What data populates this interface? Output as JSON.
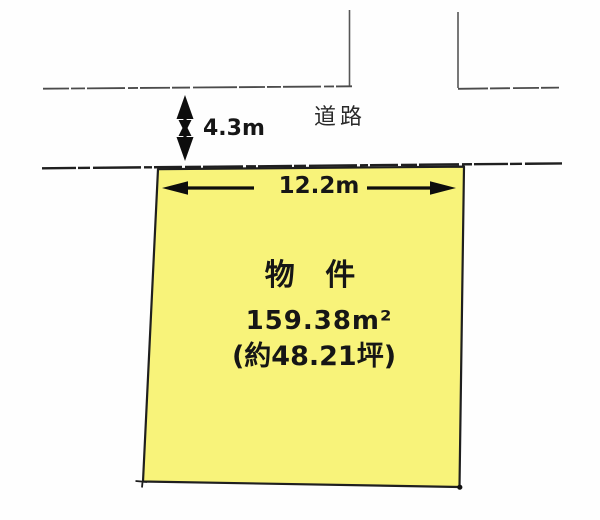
{
  "diagram": {
    "road": {
      "label": "道路",
      "width_label": "4.3m"
    },
    "parcel": {
      "frontage_label": "12.2m",
      "name": "物 件",
      "area_label": "159.38m²",
      "area_tsubo_label": "(約48.21坪)",
      "fill_color": "#f8f37a"
    },
    "colors": {
      "line": "#2a2a2a",
      "boundary_line": "#1f1f1f",
      "background": "#fefefe"
    }
  }
}
